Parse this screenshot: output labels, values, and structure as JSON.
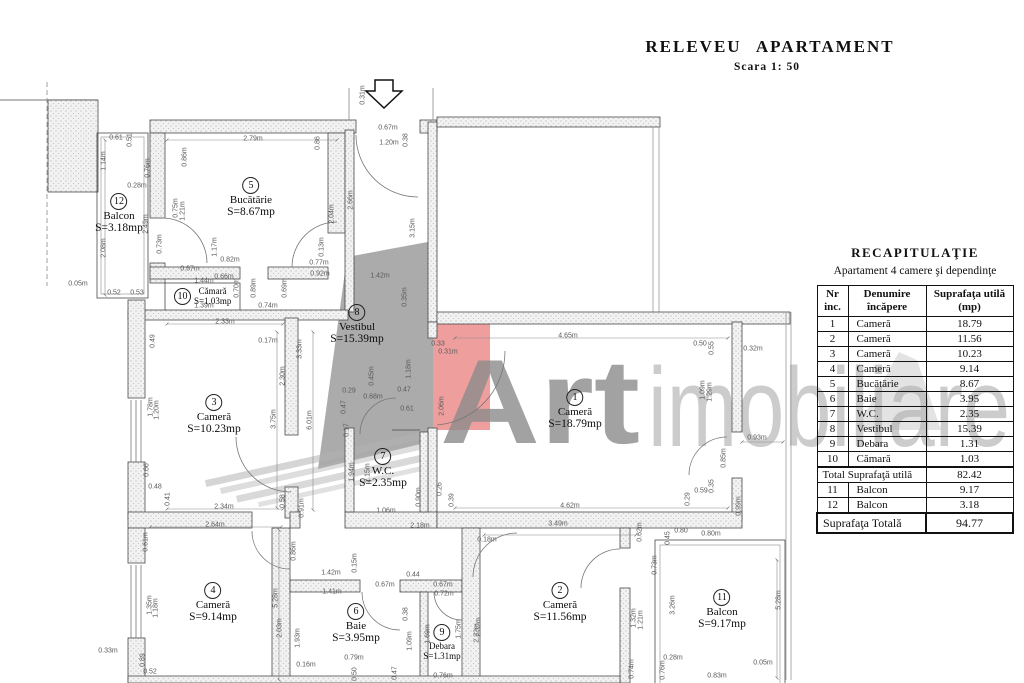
{
  "title": {
    "main": "RELEVEU APARTAMENT",
    "scale": "Scara 1: 50"
  },
  "watermark": {
    "art": "Art",
    "imobiliare": "imobiliare",
    "art_color": "#8c8c8c",
    "imobiliare_color": "#aeaeae",
    "accent_red": "#ec8d8d",
    "stroke_gray": "#969696"
  },
  "recap": {
    "heading": "RECAPITULAŢIE",
    "subheading": "Apartament 4 camere şi dependinţe",
    "columns": [
      [
        "Nr",
        "inc."
      ],
      [
        "Denumire",
        "încăpere"
      ],
      [
        "Suprafaţa utilă",
        "(mp)"
      ]
    ],
    "rows": [
      [
        "1",
        "Cameră",
        "18.79"
      ],
      [
        "2",
        "Cameră",
        "11.56"
      ],
      [
        "3",
        "Cameră",
        "10.23"
      ],
      [
        "4",
        "Cameră",
        "9.14"
      ],
      [
        "5",
        "Bucătărie",
        "8.67"
      ],
      [
        "6",
        "Baie",
        "3.95"
      ],
      [
        "7",
        "W.C.",
        "2.35"
      ],
      [
        "8",
        "Vestibul",
        "15.39"
      ],
      [
        "9",
        "Debara",
        "1.31"
      ],
      [
        "10",
        "Cămară",
        "1.03"
      ]
    ],
    "total_utila": {
      "label": "Total Suprafaţă utilă",
      "value": "82.42"
    },
    "rows_balcony": [
      [
        "11",
        "Balcon",
        "9.17"
      ],
      [
        "12",
        "Balcon",
        "3.18"
      ]
    ],
    "total": {
      "label": "Suprafaţa  Totală",
      "value": "94.77"
    }
  },
  "plan": {
    "rooms": [
      {
        "num": "1",
        "name": "Cameră",
        "area": "S=18.79mp",
        "cx": 575,
        "cy": 397
      },
      {
        "num": "2",
        "name": "Cameră",
        "area": "S=11.56mp",
        "cx": 560,
        "cy": 590
      },
      {
        "num": "3",
        "name": "Cameră",
        "area": "S=10.23mp",
        "cx": 214,
        "cy": 402
      },
      {
        "num": "4",
        "name": "Cameră",
        "area": "S=9.14mp",
        "cx": 213,
        "cy": 590
      },
      {
        "num": "5",
        "name": "Bucătărie",
        "area": "S=8.67mp",
        "cx": 251,
        "cy": 185
      },
      {
        "num": "6",
        "name": "Baie",
        "area": "S=3.95mp",
        "cx": 356,
        "cy": 611
      },
      {
        "num": "7",
        "name": "W.C.",
        "area": "S=2.35mp",
        "cx": 383,
        "cy": 456
      },
      {
        "num": "8",
        "name": "Vestibul",
        "area": "S=15.39mp",
        "cx": 357,
        "cy": 312
      },
      {
        "num": "9",
        "name": "Debara",
        "area": "S=1.31mp",
        "cx": 442,
        "cy": 632,
        "small": true
      },
      {
        "num": "10",
        "name": "Cămară",
        "area": "S=1.03mp",
        "cx": 184,
        "cy": 296,
        "row": true,
        "small": true
      },
      {
        "num": "11",
        "name": "Balcon",
        "area": "S=9.17mp",
        "cx": 722,
        "cy": 597
      },
      {
        "num": "12",
        "name": "Balcon",
        "area": "S=3.18mp",
        "cx": 119,
        "cy": 201
      }
    ],
    "dims": [
      {
        "t": "0.61",
        "x": 116,
        "y": 138,
        "r": 0
      },
      {
        "t": "0.51",
        "x": 130,
        "y": 140,
        "r": 90
      },
      {
        "t": "1.14m",
        "x": 104,
        "y": 161,
        "r": 90
      },
      {
        "t": "2.79m",
        "x": 253,
        "y": 139,
        "r": 0
      },
      {
        "t": "0.86m",
        "x": 185,
        "y": 157,
        "r": 90
      },
      {
        "t": "0.86",
        "x": 318,
        "y": 143,
        "r": 90
      },
      {
        "t": "0.28m",
        "x": 137,
        "y": 186,
        "r": 0
      },
      {
        "t": "0.76m",
        "x": 148,
        "y": 168,
        "r": 90
      },
      {
        "t": "2.49m",
        "x": 146,
        "y": 224,
        "r": 90
      },
      {
        "t": "0.75m",
        "x": 176,
        "y": 208,
        "r": 90
      },
      {
        "t": "1.21m",
        "x": 183,
        "y": 211,
        "r": 90
      },
      {
        "t": "2.08m",
        "x": 104,
        "y": 248,
        "r": 90
      },
      {
        "t": "0.73m",
        "x": 160,
        "y": 244,
        "r": 90
      },
      {
        "t": "1.17m",
        "x": 215,
        "y": 247,
        "r": 90
      },
      {
        "t": "0.82m",
        "x": 230,
        "y": 260,
        "r": 0
      },
      {
        "t": "0.67m",
        "x": 190,
        "y": 269,
        "r": 0
      },
      {
        "t": "1.44m",
        "x": 204,
        "y": 281,
        "r": 0
      },
      {
        "t": "0.66m",
        "x": 224,
        "y": 277,
        "r": 0
      },
      {
        "t": "0.70m",
        "x": 237,
        "y": 288,
        "r": 90
      },
      {
        "t": "0.89m",
        "x": 254,
        "y": 288,
        "r": 90
      },
      {
        "t": "0.69m",
        "x": 285,
        "y": 288,
        "r": 90
      },
      {
        "t": "2.04m",
        "x": 332,
        "y": 214,
        "r": 90
      },
      {
        "t": "0.13m",
        "x": 322,
        "y": 247,
        "r": 90
      },
      {
        "t": "0.77m",
        "x": 319,
        "y": 263,
        "r": 0
      },
      {
        "t": "0.92m",
        "x": 320,
        "y": 274,
        "r": 0
      },
      {
        "t": "2.66m",
        "x": 351,
        "y": 200,
        "r": 90
      },
      {
        "t": "0.05m",
        "x": 78,
        "y": 284,
        "r": 0
      },
      {
        "t": "0.52",
        "x": 114,
        "y": 293,
        "r": 0
      },
      {
        "t": "0.53",
        "x": 137,
        "y": 293,
        "r": 0
      },
      {
        "t": "1.39m",
        "x": 204,
        "y": 306,
        "r": 0
      },
      {
        "t": "0.74m",
        "x": 268,
        "y": 306,
        "r": 0
      },
      {
        "t": "0.31m",
        "x": 363,
        "y": 95,
        "r": 90
      },
      {
        "t": "0.67m",
        "x": 388,
        "y": 128,
        "r": 0
      },
      {
        "t": "1.20m",
        "x": 389,
        "y": 143,
        "r": 0
      },
      {
        "t": "0.38",
        "x": 406,
        "y": 140,
        "r": 90
      },
      {
        "t": "3.15m",
        "x": 413,
        "y": 228,
        "r": 90
      },
      {
        "t": "1.42m",
        "x": 380,
        "y": 276,
        "r": 0
      },
      {
        "t": "2.33m",
        "x": 225,
        "y": 322,
        "r": 0
      },
      {
        "t": "0.17m",
        "x": 268,
        "y": 341,
        "r": 0
      },
      {
        "t": "0.49",
        "x": 153,
        "y": 341,
        "r": 90
      },
      {
        "t": "3.33m",
        "x": 300,
        "y": 349,
        "r": 90
      },
      {
        "t": "2.30m",
        "x": 283,
        "y": 376,
        "r": 90
      },
      {
        "t": "1.78m",
        "x": 151,
        "y": 407,
        "r": 90
      },
      {
        "t": "1.20m",
        "x": 157,
        "y": 410,
        "r": 90
      },
      {
        "t": "3.75m",
        "x": 274,
        "y": 419,
        "r": 90
      },
      {
        "t": "6.01m",
        "x": 310,
        "y": 420,
        "r": 90
      },
      {
        "t": "0.66",
        "x": 147,
        "y": 470,
        "r": 90
      },
      {
        "t": "0.48",
        "x": 155,
        "y": 487,
        "r": 0
      },
      {
        "t": "0.41",
        "x": 168,
        "y": 499,
        "r": 90
      },
      {
        "t": "2.34m",
        "x": 224,
        "y": 507,
        "r": 0
      },
      {
        "t": "0.58",
        "x": 283,
        "y": 501,
        "r": 90
      },
      {
        "t": "0.91m",
        "x": 302,
        "y": 508,
        "r": 90
      },
      {
        "t": "2.64m",
        "x": 215,
        "y": 525,
        "r": 0
      },
      {
        "t": "0.35m",
        "x": 405,
        "y": 297,
        "r": 90
      },
      {
        "t": "1.18m",
        "x": 409,
        "y": 369,
        "r": 90
      },
      {
        "t": "0.45m",
        "x": 372,
        "y": 376,
        "r": 90
      },
      {
        "t": "0.29",
        "x": 349,
        "y": 391,
        "r": 0
      },
      {
        "t": "0.68m",
        "x": 373,
        "y": 397,
        "r": 0
      },
      {
        "t": "0.47",
        "x": 344,
        "y": 407,
        "r": 90
      },
      {
        "t": "0.47",
        "x": 404,
        "y": 390,
        "r": 0
      },
      {
        "t": "0.61",
        "x": 407,
        "y": 409,
        "r": 0
      },
      {
        "t": "0.17",
        "x": 347,
        "y": 430,
        "r": 90
      },
      {
        "t": "1.94m",
        "x": 352,
        "y": 472,
        "r": 90
      },
      {
        "t": "2.15m",
        "x": 368,
        "y": 473,
        "r": 90
      },
      {
        "t": "0.90m",
        "x": 419,
        "y": 497,
        "r": 90
      },
      {
        "t": "1.06m",
        "x": 386,
        "y": 511,
        "r": 0
      },
      {
        "t": "2.18m",
        "x": 420,
        "y": 526,
        "r": 0
      },
      {
        "t": "0.33",
        "x": 438,
        "y": 344,
        "r": 0
      },
      {
        "t": "0.31m",
        "x": 448,
        "y": 352,
        "r": 0
      },
      {
        "t": "4.65m",
        "x": 568,
        "y": 336,
        "r": 0
      },
      {
        "t": "0.50",
        "x": 700,
        "y": 344,
        "r": 0
      },
      {
        "t": "0.55",
        "x": 712,
        "y": 348,
        "r": 90
      },
      {
        "t": "0.32m",
        "x": 753,
        "y": 349,
        "r": 0
      },
      {
        "t": "1.09m",
        "x": 703,
        "y": 390,
        "r": 90
      },
      {
        "t": "1.29m",
        "x": 710,
        "y": 392,
        "r": 90
      },
      {
        "t": "2.06m",
        "x": 442,
        "y": 406,
        "r": 90
      },
      {
        "t": "0.93m",
        "x": 757,
        "y": 438,
        "r": 0
      },
      {
        "t": "0.85m",
        "x": 724,
        "y": 458,
        "r": 90
      },
      {
        "t": "0.26",
        "x": 440,
        "y": 489,
        "r": 90
      },
      {
        "t": "0.39",
        "x": 452,
        "y": 500,
        "r": 90
      },
      {
        "t": "4.62m",
        "x": 570,
        "y": 506,
        "r": 0
      },
      {
        "t": "0.29",
        "x": 688,
        "y": 499,
        "r": 90
      },
      {
        "t": "0.59",
        "x": 701,
        "y": 491,
        "r": 0
      },
      {
        "t": "0.35",
        "x": 712,
        "y": 486,
        "r": 90
      },
      {
        "t": "0.99m",
        "x": 739,
        "y": 506,
        "r": 90
      },
      {
        "t": "0.61m",
        "x": 146,
        "y": 542,
        "r": 90
      },
      {
        "t": "0.86m",
        "x": 294,
        "y": 551,
        "r": 90
      },
      {
        "t": "3.49m",
        "x": 558,
        "y": 524,
        "r": 0
      },
      {
        "t": "0.18m",
        "x": 487,
        "y": 540,
        "r": 0
      },
      {
        "t": "1.42m",
        "x": 331,
        "y": 573,
        "r": 0
      },
      {
        "t": "0.15m",
        "x": 355,
        "y": 563,
        "r": 90
      },
      {
        "t": "1.41m",
        "x": 332,
        "y": 592,
        "r": 0
      },
      {
        "t": "0.67m",
        "x": 385,
        "y": 585,
        "r": 0
      },
      {
        "t": "0.44",
        "x": 413,
        "y": 575,
        "r": 0
      },
      {
        "t": "0.67m",
        "x": 443,
        "y": 585,
        "r": 0
      },
      {
        "t": "0.72m",
        "x": 444,
        "y": 594,
        "r": 0
      },
      {
        "t": "1.35m",
        "x": 150,
        "y": 605,
        "r": 90
      },
      {
        "t": "1.18m",
        "x": 156,
        "y": 608,
        "r": 90
      },
      {
        "t": "5.28m",
        "x": 276,
        "y": 598,
        "r": 90
      },
      {
        "t": "2.03m",
        "x": 280,
        "y": 628,
        "r": 90
      },
      {
        "t": "1.93m",
        "x": 298,
        "y": 638,
        "r": 90
      },
      {
        "t": "0.38",
        "x": 406,
        "y": 614,
        "r": 90
      },
      {
        "t": "1.09m",
        "x": 410,
        "y": 641,
        "r": 90
      },
      {
        "t": "1.69m",
        "x": 428,
        "y": 634,
        "r": 90
      },
      {
        "t": "1.75m",
        "x": 459,
        "y": 629,
        "r": 90
      },
      {
        "t": "2.22m",
        "x": 477,
        "y": 633,
        "r": 90
      },
      {
        "t": "0.79m",
        "x": 354,
        "y": 658,
        "r": 0
      },
      {
        "t": "0.16m",
        "x": 306,
        "y": 665,
        "r": 0
      },
      {
        "t": "0.50",
        "x": 355,
        "y": 674,
        "r": 90
      },
      {
        "t": "0.47",
        "x": 395,
        "y": 673,
        "r": 90
      },
      {
        "t": "0.76m",
        "x": 443,
        "y": 676,
        "r": 0
      },
      {
        "t": "2.32m",
        "x": 479,
        "y": 627,
        "r": 90
      },
      {
        "t": "0.33m",
        "x": 108,
        "y": 651,
        "r": 0
      },
      {
        "t": "0.89",
        "x": 143,
        "y": 660,
        "r": 90
      },
      {
        "t": "0.52",
        "x": 150,
        "y": 672,
        "r": 0
      },
      {
        "t": "0.62m",
        "x": 640,
        "y": 532,
        "r": 90
      },
      {
        "t": "0.45",
        "x": 668,
        "y": 538,
        "r": 90
      },
      {
        "t": "0.80",
        "x": 681,
        "y": 531,
        "r": 0
      },
      {
        "t": "0.80m",
        "x": 711,
        "y": 534,
        "r": 0
      },
      {
        "t": "0.73m",
        "x": 655,
        "y": 565,
        "r": 90
      },
      {
        "t": "3.26m",
        "x": 673,
        "y": 605,
        "r": 90
      },
      {
        "t": "1.32m",
        "x": 634,
        "y": 618,
        "r": 90
      },
      {
        "t": "1.21m",
        "x": 641,
        "y": 620,
        "r": 90
      },
      {
        "t": "0.28m",
        "x": 673,
        "y": 658,
        "r": 0
      },
      {
        "t": "0.74m",
        "x": 632,
        "y": 669,
        "r": 90
      },
      {
        "t": "0.76m",
        "x": 663,
        "y": 670,
        "r": 90
      },
      {
        "t": "5.28m",
        "x": 779,
        "y": 600,
        "r": 90
      },
      {
        "t": "0.05m",
        "x": 763,
        "y": 663,
        "r": 0
      },
      {
        "t": "0.83m",
        "x": 717,
        "y": 676,
        "r": 0
      }
    ]
  }
}
